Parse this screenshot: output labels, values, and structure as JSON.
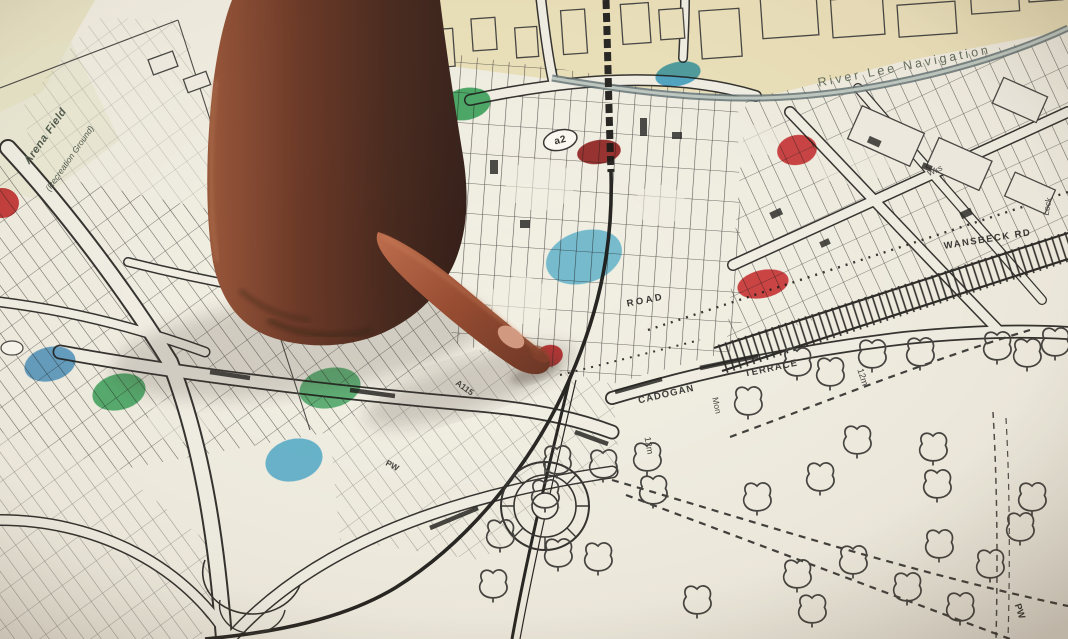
{
  "meta": {
    "description": "Photograph of a hand with index finger pointing at a paper street map marked with red, green and blue marker dots",
    "width": 1068,
    "height": 639
  },
  "colors": {
    "paper": "#f2f0e6",
    "paper_cream": "#eadfb4",
    "ink": "#1d1d1d",
    "canal": "#55666b",
    "marker_red": "#c4171c",
    "marker_red_dark": "#8e1014",
    "marker_green": "#169a48",
    "marker_blue": "#2296cc",
    "skin_dark": "#35130a",
    "skin_light": "#b9603f"
  },
  "map": {
    "labels": [
      {
        "text": "Arena Field",
        "x": 48,
        "y": 138,
        "rot": -55,
        "size": 11,
        "color": "#3d4a3d",
        "style": "italic",
        "weight": 700,
        "ls": 0.5,
        "name": "arena-field-label"
      },
      {
        "text": "(Recreation Ground)",
        "x": 72,
        "y": 160,
        "rot": -55,
        "size": 8.5,
        "color": "#3d4a3d",
        "style": "italic",
        "weight": 400,
        "ls": 0,
        "name": "recreation-ground-label"
      },
      {
        "text": "River Lee Navigation",
        "x": 905,
        "y": 70,
        "rot": -11,
        "size": 12.5,
        "color": "#55604f",
        "style": "normal",
        "weight": 400,
        "ls": 3,
        "name": "river-lee-navigation-label"
      },
      {
        "text": "WANSBECK RD",
        "x": 988,
        "y": 242,
        "rot": -9,
        "size": 9.5,
        "color": "#222222",
        "style": "normal",
        "weight": 700,
        "ls": 1.5,
        "name": "wansbeck-rd-label"
      },
      {
        "text": "ROAD",
        "x": 646,
        "y": 303,
        "rot": -11,
        "size": 9.5,
        "color": "#1d1d1d",
        "style": "normal",
        "weight": 700,
        "ls": 2.5,
        "name": "road-label"
      },
      {
        "text": "CADOGAN",
        "x": 667,
        "y": 397,
        "rot": -13,
        "size": 9.5,
        "color": "#262626",
        "style": "normal",
        "weight": 700,
        "ls": 1.2,
        "name": "cadogan-label"
      },
      {
        "text": "TERRACE",
        "x": 772,
        "y": 371,
        "rot": -12,
        "size": 9.5,
        "color": "#262626",
        "style": "normal",
        "weight": 700,
        "ls": 1.2,
        "name": "terrace-label"
      },
      {
        "text": "Mon",
        "x": 714,
        "y": 406,
        "rot": 78,
        "size": 8.5,
        "color": "#333333",
        "style": "normal",
        "weight": 400,
        "ls": 0,
        "name": "mon-label"
      },
      {
        "text": "12m",
        "x": 860,
        "y": 378,
        "rot": 72,
        "size": 9,
        "color": "#2a2a2a",
        "style": "normal",
        "weight": 400,
        "ls": 0,
        "name": "contour-12m-label-1"
      },
      {
        "text": "12m",
        "x": 646,
        "y": 446,
        "rot": 80,
        "size": 9,
        "color": "#2a2a2a",
        "style": "normal",
        "weight": 400,
        "ls": 0,
        "name": "contour-12m-label-2"
      },
      {
        "text": "a2",
        "x": 561,
        "y": 143,
        "rot": -14,
        "size": 10,
        "color": "#1a1a1a",
        "style": "normal",
        "weight": 700,
        "ls": 0.5,
        "oval": true,
        "name": "a2-route-badge"
      },
      {
        "text": "A115",
        "x": 463,
        "y": 390,
        "rot": 36,
        "size": 8.5,
        "color": "#333333",
        "style": "normal",
        "weight": 700,
        "ls": 0,
        "name": "a115-route-label"
      },
      {
        "text": "PW",
        "x": 1017,
        "y": 612,
        "rot": 72,
        "size": 9.5,
        "color": "#222222",
        "style": "normal",
        "weight": 700,
        "ls": 0,
        "name": "pw-label-1"
      },
      {
        "text": "PW",
        "x": 391,
        "y": 468,
        "rot": 28,
        "size": 8.5,
        "color": "#333333",
        "style": "normal",
        "weight": 700,
        "ls": 0,
        "name": "pw-label-2"
      },
      {
        "text": "Wks",
        "x": 936,
        "y": 173,
        "rot": -25,
        "size": 8,
        "color": "#333333",
        "style": "normal",
        "weight": 400,
        "ls": 0,
        "name": "works-label"
      },
      {
        "text": "Lock",
        "x": 1050,
        "y": 207,
        "rot": -80,
        "size": 8.5,
        "color": "#333333",
        "style": "normal",
        "weight": 400,
        "ls": 0,
        "name": "lock-label"
      }
    ],
    "marker_dots": [
      {
        "color": "red",
        "hex": "#c4171c",
        "x": 2,
        "y": 203,
        "rx": 17,
        "ry": 15,
        "rot": 0,
        "opacity": 0.92
      },
      {
        "color": "red",
        "hex": "#8e1014",
        "x": 599,
        "y": 152,
        "rx": 22,
        "ry": 12,
        "rot": -8,
        "opacity": 0.95
      },
      {
        "color": "red",
        "hex": "#cc1a20",
        "x": 797,
        "y": 150,
        "rx": 20,
        "ry": 15,
        "rot": -10,
        "opacity": 0.9
      },
      {
        "color": "red",
        "hex": "#cc1a20",
        "x": 763,
        "y": 284,
        "rx": 26,
        "ry": 14,
        "rot": -12,
        "opacity": 0.9
      },
      {
        "color": "red",
        "hex": "#c4171c",
        "x": 549,
        "y": 356,
        "rx": 14,
        "ry": 11,
        "rot": -15,
        "opacity": 0.95
      },
      {
        "color": "green",
        "hex": "#169a48",
        "x": 466,
        "y": 104,
        "rx": 25,
        "ry": 16,
        "rot": -12,
        "opacity": 0.85
      },
      {
        "color": "green",
        "hex": "#169a48",
        "x": 119,
        "y": 392,
        "rx": 27,
        "ry": 18,
        "rot": -14,
        "opacity": 0.8
      },
      {
        "color": "green",
        "hex": "#169a48",
        "x": 330,
        "y": 388,
        "rx": 31,
        "ry": 20,
        "rot": -12,
        "opacity": 0.75
      },
      {
        "color": "blue",
        "hex": "#1d96cc",
        "x": 678,
        "y": 74,
        "rx": 23,
        "ry": 12,
        "rot": -12,
        "opacity": 0.85
      },
      {
        "color": "blue",
        "hex": "#2b86c8",
        "x": 50,
        "y": 364,
        "rx": 26,
        "ry": 17,
        "rot": -14,
        "opacity": 0.8
      },
      {
        "color": "blue",
        "hex": "#22a0d8",
        "x": 294,
        "y": 460,
        "rx": 29,
        "ry": 21,
        "rot": -15,
        "opacity": 0.75
      },
      {
        "color": "blue",
        "hex": "#2fa8da",
        "x": 584,
        "y": 257,
        "rx": 39,
        "ry": 26,
        "rot": -18,
        "opacity": 0.7
      }
    ],
    "trees": [
      [
        748,
        404
      ],
      [
        797,
        365
      ],
      [
        830,
        375
      ],
      [
        872,
        357
      ],
      [
        920,
        355
      ],
      [
        997,
        349
      ],
      [
        1027,
        356
      ],
      [
        1055,
        345
      ],
      [
        797,
        577
      ],
      [
        812,
        612
      ],
      [
        853,
        563
      ],
      [
        857,
        443
      ],
      [
        907,
        590
      ],
      [
        933,
        450
      ],
      [
        937,
        487
      ],
      [
        939,
        547
      ],
      [
        990,
        567
      ],
      [
        1020,
        530
      ],
      [
        1032,
        500
      ],
      [
        545,
        497
      ],
      [
        557,
        463
      ],
      [
        603,
        467
      ],
      [
        500,
        537
      ],
      [
        493,
        587
      ],
      [
        558,
        556
      ],
      [
        598,
        560
      ],
      [
        653,
        493
      ],
      [
        647,
        460
      ],
      [
        697,
        603
      ],
      [
        757,
        500
      ],
      [
        820,
        480
      ],
      [
        960,
        610
      ]
    ]
  },
  "hand": {
    "description": "dark silhouetted forearm and fist entering from top edge, index finger extended pointing at map",
    "fingertip": {
      "x": 545,
      "y": 357
    }
  }
}
